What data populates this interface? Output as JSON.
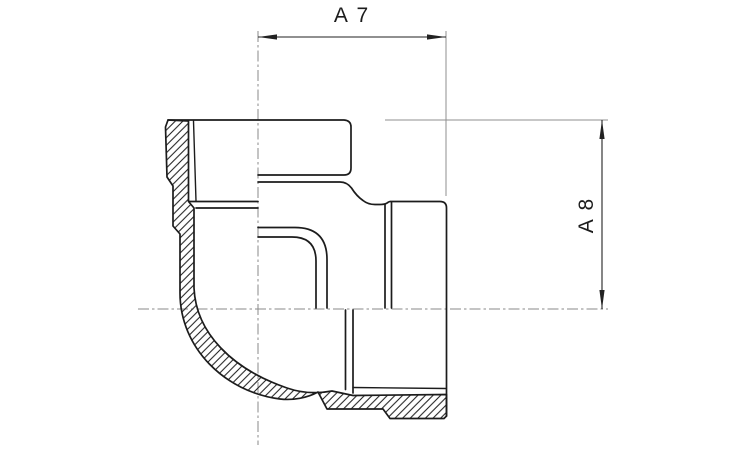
{
  "drawing": {
    "figure": "pipe-elbow-half-section",
    "description": "90-degree female threaded elbow fitting shown in half section with hatched cut walls",
    "dimensions": {
      "horizontal": {
        "label": "A 7"
      },
      "vertical": {
        "label": "A 8"
      }
    },
    "colors": {
      "background": "#ffffff",
      "outline": "#1c1c1c",
      "dimension_line": "#222222",
      "extension_line": "#8f8f8f",
      "centerline": "#8a8a8a"
    }
  }
}
